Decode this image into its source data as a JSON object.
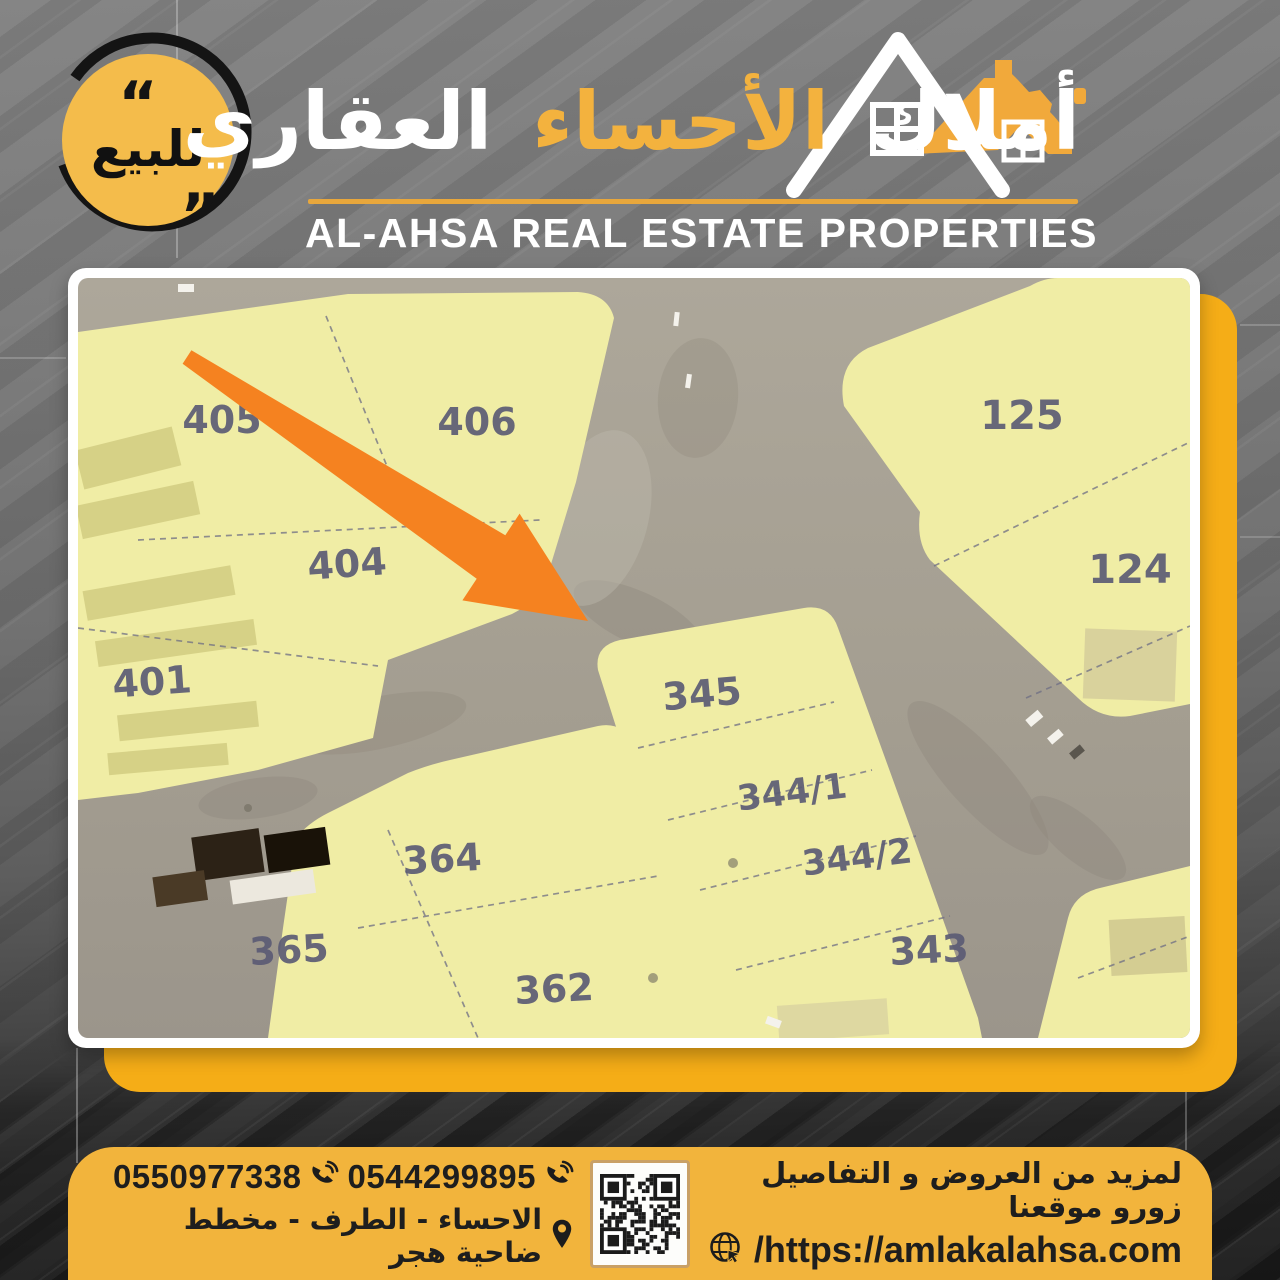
{
  "badge": {
    "label": "للبيع",
    "quote_open": "“",
    "quote_close": "”"
  },
  "logo": {
    "arabic_word1": "أملاك",
    "arabic_word2": "الأحساء",
    "arabic_word3": "العقاري",
    "english": "AL-AHSA REAL ESTATE PROPERTIES"
  },
  "map": {
    "plots": [
      {
        "label": "405"
      },
      {
        "label": "406"
      },
      {
        "label": "125"
      },
      {
        "label": "404"
      },
      {
        "label": "124"
      },
      {
        "label": "401"
      },
      {
        "label": "345"
      },
      {
        "label": "344/1"
      },
      {
        "label": "344/2"
      },
      {
        "label": "364"
      },
      {
        "label": "365"
      },
      {
        "label": "362"
      },
      {
        "label": "343"
      }
    ]
  },
  "contact": {
    "phone_primary": "0550977338",
    "phone_secondary": "0544299895",
    "location": "الاحساء - الطرف - مخطط ضاحية هجر",
    "promo": "لمزيد من العروض و التفاصيل زورو موقعنا",
    "website": "/https://amlakalahsa.com"
  },
  "colors": {
    "badge_yellow": "#F4BC4B",
    "card_yellow": "#F5AD17",
    "bar_yellow": "#F2B43C",
    "logo_gold": "#F3B23E",
    "arrow_orange": "#F58220",
    "parcel_yellow": "#F0EDA5",
    "road_gray": "#A49E91",
    "plot_number": "#5B5B74",
    "dark_text": "#1E1E1E"
  }
}
